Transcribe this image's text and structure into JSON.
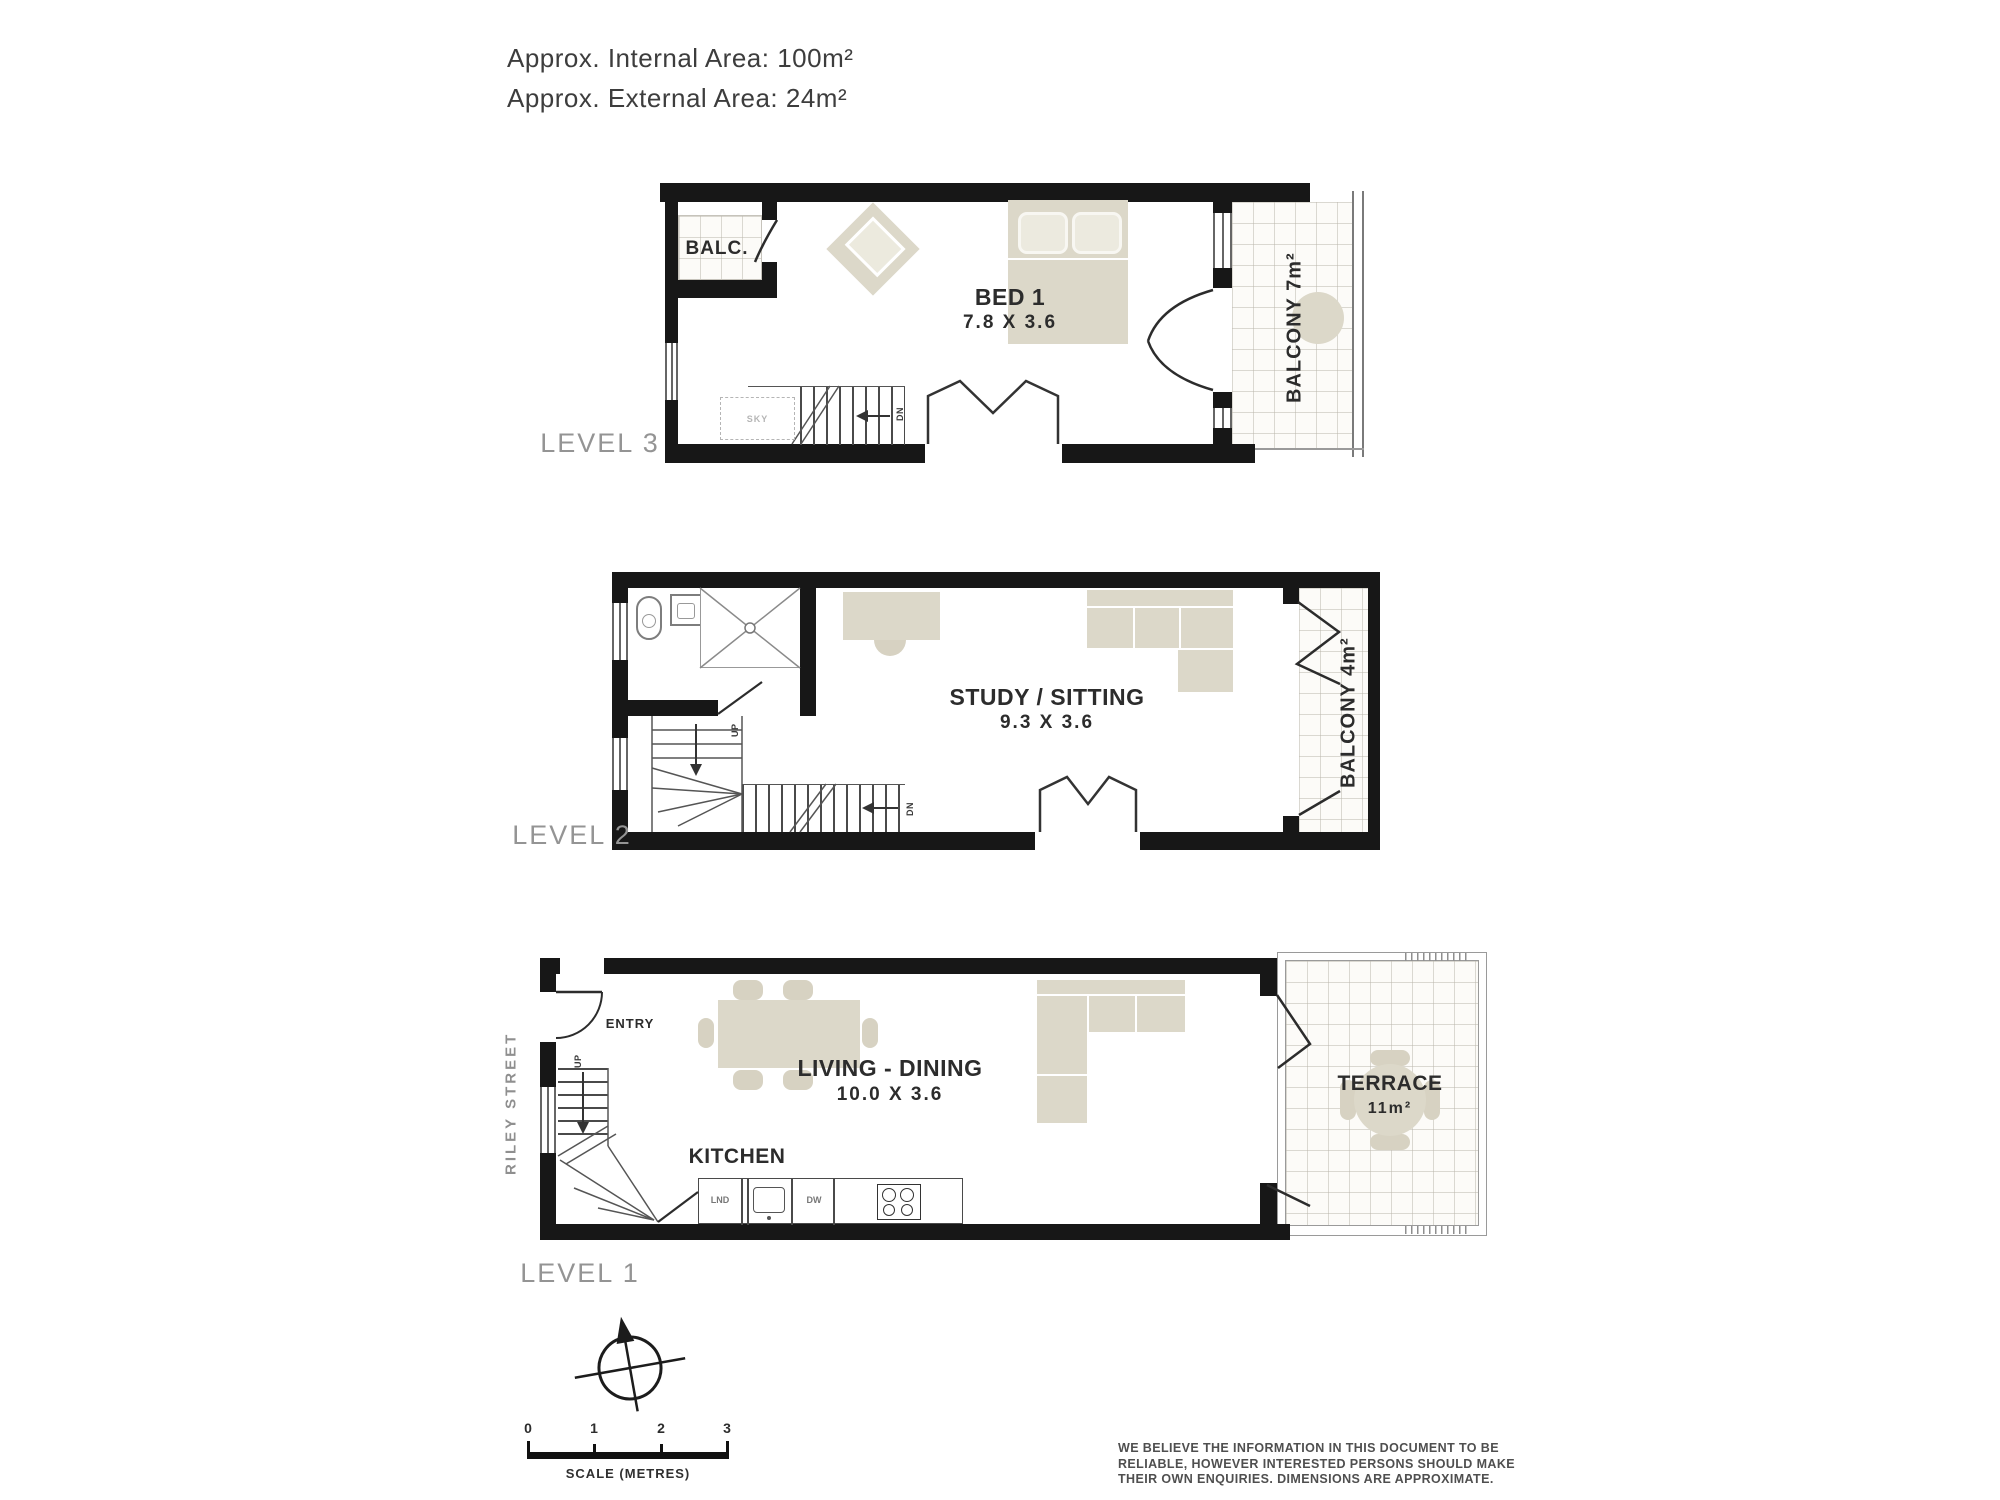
{
  "header": {
    "internal_area": "Approx. Internal Area: 100m²",
    "external_area": "Approx. External Area: 24m²"
  },
  "level3": {
    "label": "LEVEL 3",
    "balc_label": "BALC.",
    "room_name": "BED 1",
    "room_dims": "7.8 X 3.6",
    "balcony_label": "BALCONY 7m²",
    "skylight_label": "SKY",
    "stairs_dn": "DN"
  },
  "level2": {
    "label": "LEVEL 2",
    "room_name": "STUDY / SITTING",
    "room_dims": "9.3 X 3.6",
    "balcony_label": "BALCONY 4m²",
    "stairs_up": "UP",
    "stairs_dn": "DN"
  },
  "level1": {
    "label": "LEVEL 1",
    "street_name": "RILEY STREET",
    "entry_label": "ENTRY",
    "stairs_up": "UP",
    "room_name": "LIVING - DINING",
    "room_dims": "10.0 X 3.6",
    "kitchen_label": "KITCHEN",
    "laundry_label": "LND",
    "dishwasher_label": "DW",
    "terrace_name": "TERRACE",
    "terrace_area": "11m²"
  },
  "scale_bar": {
    "ticks": [
      "0",
      "1",
      "2",
      "3"
    ],
    "caption": "SCALE (METRES)"
  },
  "disclaimer": [
    "WE BELIEVE THE INFORMATION IN THIS DOCUMENT TO BE",
    "RELIABLE, HOWEVER INTERESTED PERSONS SHOULD MAKE",
    "THEIR OWN ENQUIRIES. DIMENSIONS ARE APPROXIMATE."
  ],
  "colors": {
    "wall": "#171717",
    "furniture": "#dcd8c9",
    "label_grey": "#949494",
    "text_dark": "#2d2d2d"
  }
}
